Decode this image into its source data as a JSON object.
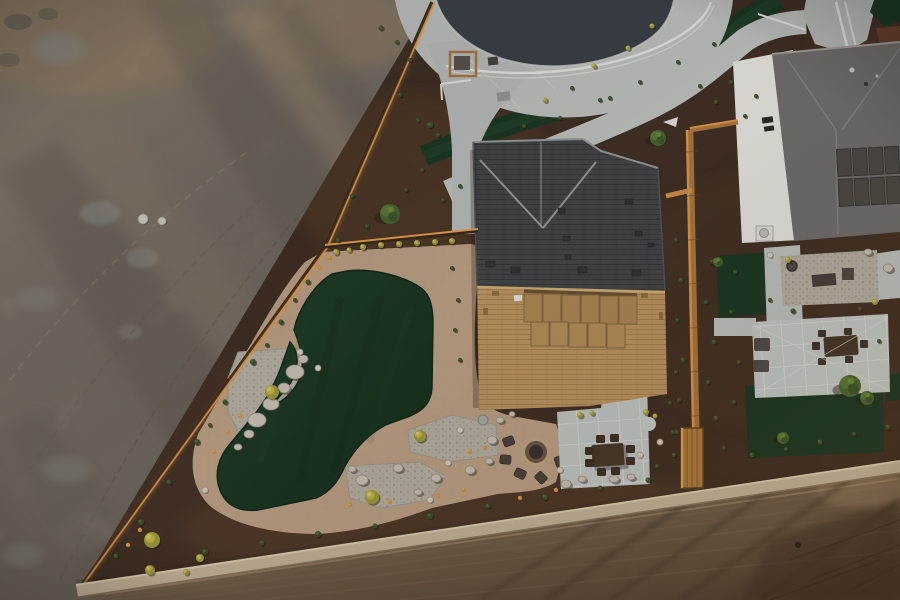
{
  "meta": {
    "type": "aerial-drone-photograph",
    "description": "Top-down sunset drone view of a new-build desert home with artificial-turf putting green backyard, fire pit and paver dining patio; vacant graded dirt lot to the west, cul-de-sac street with curving sidewalks and turf ribbon to the north, neighboring solar-roof house to the east, graded dirt road to the south",
    "width": 900,
    "height": 600
  },
  "palette": {
    "lot": "#978c7e",
    "lot_warm": "#c3a37d",
    "lot_shadow": "#6f675d",
    "lot_chalk": "#b9bab4",
    "road": "#9c8468",
    "road_light": "#cdb28f",
    "road_shadow": "#4f4336",
    "mulch": "#4e3a2c",
    "mulch_warm": "#6b4a33",
    "concrete": "#c5c8c5",
    "concrete2": "#bfc3c0",
    "asphalt": "#3e444b",
    "turf": "#1e3b25",
    "turf_light": "#27492f",
    "path_tan": "#c2a588",
    "gravel": "#bcb5a8",
    "roof_shaded": "#474849",
    "roof_ridge": "#9aa0a3",
    "roof_sunlit": "#c39a64",
    "patio_panel": "#b28c59",
    "white_wall": "#efece6",
    "gray_roof": "#767270",
    "solar": "#524d48",
    "fence_wood": "#b07b42",
    "fence_glow": "#e89a4a",
    "fence_dark": "#2e241c",
    "block_wall": "#c9b99e",
    "boulder": "#cfc8ba",
    "furniture": "#4a3b2e",
    "shrub_green": "#3d5330",
    "shrub_yellow": "#c9b84a",
    "rail_white": "#eceeea"
  },
  "scene": {
    "regions": [
      {
        "name": "vacant-dirt-lot",
        "desc": "graded sandy lot with tire tracks and long shadows, west of fence"
      },
      {
        "name": "culdesac-street",
        "desc": "dark asphalt cul-de-sac with concrete apron, white handrail, S-curving turf ribbon and walking path"
      },
      {
        "name": "main-house",
        "desc": "hip roof, shaded north slope / sunlit tan south slope with covered patio panels"
      },
      {
        "name": "putting-green-backyard",
        "desc": "boot-shaped artificial turf with decomposed granite loop path, gravel beds, boulders, fire pit, paver dining patio"
      },
      {
        "name": "right-house",
        "desc": "neighbor with white walls, gray roof, solar panels, paver patio with string lights"
      },
      {
        "name": "dirt-road",
        "desc": "graded warm dirt road south of block wall with long diagonal shadows"
      }
    ],
    "plants": {
      "green_shrubs": [
        [
          308,
          282,
          2.5
        ],
        [
          281,
          322,
          2.5
        ],
        [
          253,
          362,
          3
        ],
        [
          225,
          402,
          2.5
        ],
        [
          197,
          442,
          3
        ],
        [
          169,
          482,
          2.5
        ],
        [
          141,
          522,
          3
        ],
        [
          116,
          556,
          2.5
        ],
        [
          295,
          300,
          2
        ],
        [
          267,
          345,
          2
        ],
        [
          210,
          425,
          2
        ],
        [
          205,
          552,
          3
        ],
        [
          262,
          543,
          2.5
        ],
        [
          318,
          534,
          3
        ],
        [
          375,
          526,
          2.5
        ],
        [
          430,
          516,
          3
        ],
        [
          488,
          506,
          2.5
        ],
        [
          545,
          497,
          3
        ],
        [
          600,
          488,
          2.5
        ],
        [
          648,
          480,
          2.5
        ],
        [
          676,
          240,
          2
        ],
        [
          681,
          280,
          2.5
        ],
        [
          677,
          320,
          2
        ],
        [
          683,
          360,
          2.5
        ],
        [
          679,
          400,
          2
        ],
        [
          673,
          432,
          2
        ],
        [
          712,
          262,
          2.5
        ],
        [
          706,
          302,
          2
        ],
        [
          714,
          342,
          2.5
        ],
        [
          708,
          382,
          2
        ],
        [
          716,
          418,
          2.5
        ],
        [
          724,
          448,
          2
        ],
        [
          752,
          455,
          2.5
        ],
        [
          786,
          449,
          2
        ],
        [
          820,
          442,
          2.5
        ],
        [
          854,
          434,
          2
        ],
        [
          888,
          427,
          2.5
        ],
        [
          735,
          272,
          2
        ],
        [
          731,
          312,
          2
        ],
        [
          739,
          362,
          2
        ],
        [
          734,
          402,
          2
        ],
        [
          793,
          311,
          2.5
        ],
        [
          860,
          309,
          2
        ],
        [
          879,
          341,
          2
        ],
        [
          770,
          300,
          2
        ],
        [
          352,
          196,
          2
        ],
        [
          367,
          226,
          2
        ],
        [
          406,
          190,
          2
        ],
        [
          422,
          170,
          2
        ],
        [
          443,
          200,
          2
        ],
        [
          460,
          186,
          2
        ],
        [
          338,
          240,
          2
        ],
        [
          430,
          125,
          3
        ],
        [
          438,
          135,
          2
        ],
        [
          524,
          126,
          2
        ],
        [
          560,
          118,
          2
        ],
        [
          600,
          100,
          2
        ],
        [
          640,
          82,
          2
        ],
        [
          678,
          62,
          2
        ],
        [
          714,
          44,
          2
        ],
        [
          610,
          98,
          2
        ],
        [
          572,
          88,
          2
        ],
        [
          657,
          466,
          2
        ],
        [
          676,
          372,
          2
        ],
        [
          670,
          403,
          2
        ],
        [
          677,
          432,
          2
        ],
        [
          674,
          455,
          2
        ],
        [
          452,
          268,
          2
        ],
        [
          458,
          300,
          2
        ],
        [
          455,
          330,
          2
        ],
        [
          460,
          360,
          2
        ],
        [
          700,
          86,
          2
        ],
        [
          716,
          102,
          2
        ],
        [
          731,
          82,
          2
        ],
        [
          745,
          116,
          2
        ],
        [
          756,
          96,
          2
        ],
        [
          410,
          60,
          2
        ],
        [
          400,
          95,
          2
        ],
        [
          418,
          120,
          2
        ],
        [
          381,
          28,
          2.5
        ],
        [
          397,
          42,
          2
        ]
      ],
      "yellow_shrubs": [
        [
          272,
          392,
          7
        ],
        [
          420,
          436,
          6
        ],
        [
          372,
          497,
          7
        ],
        [
          152,
          540,
          8
        ],
        [
          150,
          570,
          5
        ],
        [
          580,
          415,
          3
        ],
        [
          592,
          413,
          2.5
        ],
        [
          646,
          412,
          3
        ],
        [
          655,
          416,
          2.5
        ],
        [
          363,
          247,
          3
        ],
        [
          381,
          245,
          3
        ],
        [
          399,
          244,
          3
        ],
        [
          417,
          243,
          3
        ],
        [
          435,
          242,
          3
        ],
        [
          452,
          241,
          3
        ],
        [
          336,
          252,
          3
        ],
        [
          349,
          250,
          2.5
        ],
        [
          200,
          558,
          4
        ],
        [
          186,
          572,
          3
        ],
        [
          545,
          100,
          2.5
        ],
        [
          652,
          26,
          2.5
        ],
        [
          628,
          48,
          2.5
        ],
        [
          594,
          66,
          2.5
        ],
        [
          788,
          260,
          3
        ],
        [
          875,
          302,
          3
        ]
      ],
      "flowers": [
        [
          240,
          416
        ],
        [
          228,
          432
        ],
        [
          214,
          452
        ],
        [
          140,
          530
        ],
        [
          128,
          545
        ],
        [
          350,
          505
        ],
        [
          390,
          502
        ],
        [
          438,
          496
        ],
        [
          464,
          490
        ],
        [
          470,
          452
        ],
        [
          485,
          448
        ],
        [
          520,
          498
        ],
        [
          556,
          490
        ],
        [
          330,
          258
        ],
        [
          320,
          268
        ]
      ],
      "boulders": [
        [
          295,
          372,
          9,
          7
        ],
        [
          284,
          388,
          6,
          5
        ],
        [
          271,
          404,
          8,
          6
        ],
        [
          257,
          420,
          9,
          7
        ],
        [
          249,
          434,
          5,
          4
        ],
        [
          303,
          359,
          5,
          4
        ],
        [
          238,
          447,
          4,
          3
        ],
        [
          362,
          480,
          6,
          5
        ],
        [
          352,
          469,
          4,
          3
        ],
        [
          398,
          468,
          5,
          4
        ],
        [
          418,
          492,
          4,
          3
        ],
        [
          436,
          478,
          5,
          4
        ],
        [
          470,
          470,
          5,
          4
        ],
        [
          489,
          461,
          4,
          3
        ],
        [
          492,
          440,
          5,
          4
        ],
        [
          566,
          484,
          5,
          4
        ],
        [
          582,
          479,
          4,
          3
        ],
        [
          614,
          479,
          5,
          3.5
        ],
        [
          631,
          477,
          4,
          3
        ],
        [
          888,
          268,
          5,
          4
        ],
        [
          868,
          252,
          4,
          3
        ],
        [
          500,
          420,
          4,
          3
        ],
        [
          512,
          414,
          3,
          2.5
        ]
      ],
      "rocks": [
        [
          430,
          500,
          3
        ],
        [
          448,
          463,
          3
        ],
        [
          460,
          430,
          3
        ],
        [
          300,
          352,
          3
        ],
        [
          318,
          368,
          3
        ],
        [
          205,
          490,
          3
        ],
        [
          560,
          470,
          3
        ],
        [
          770,
          255,
          3
        ],
        [
          640,
          455,
          3
        ],
        [
          660,
          442,
          3
        ],
        [
          143,
          219,
          5
        ],
        [
          162,
          221,
          4
        ]
      ],
      "trees": [
        [
          390,
          214,
          10
        ],
        [
          658,
          138,
          8
        ],
        [
          850,
          386,
          11
        ],
        [
          867,
          398,
          7
        ],
        [
          783,
          438,
          6
        ],
        [
          718,
          262,
          5
        ]
      ]
    }
  }
}
